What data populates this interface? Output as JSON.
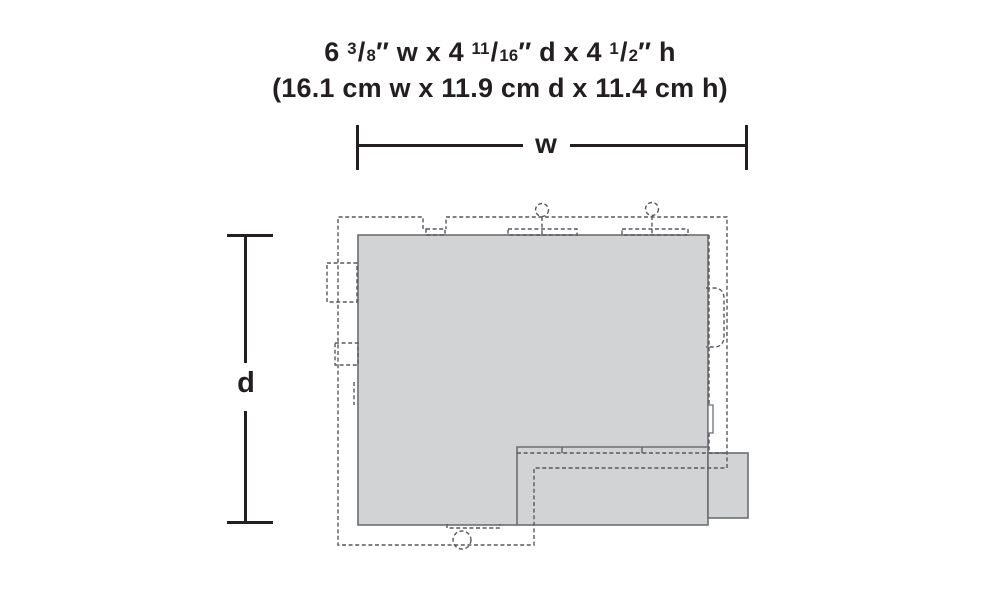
{
  "header": {
    "imperial_parts": [
      "6 ",
      "3",
      "/",
      "8",
      "″ w x 4 ",
      "11",
      "/",
      "16",
      "″ d x 4 ",
      "1",
      "/",
      "2",
      "″ h"
    ],
    "metric": "(16.1 cm w x 11.9 cm d x 11.4 cm h)"
  },
  "dimension_labels": {
    "width": "w",
    "depth": "d"
  },
  "colors": {
    "ink": "#231f20",
    "footprint_fill": "#d1d3d4",
    "footprint_stroke": "#6d6e71",
    "dashed_stroke": "#58595b",
    "background": "#ffffff"
  }
}
